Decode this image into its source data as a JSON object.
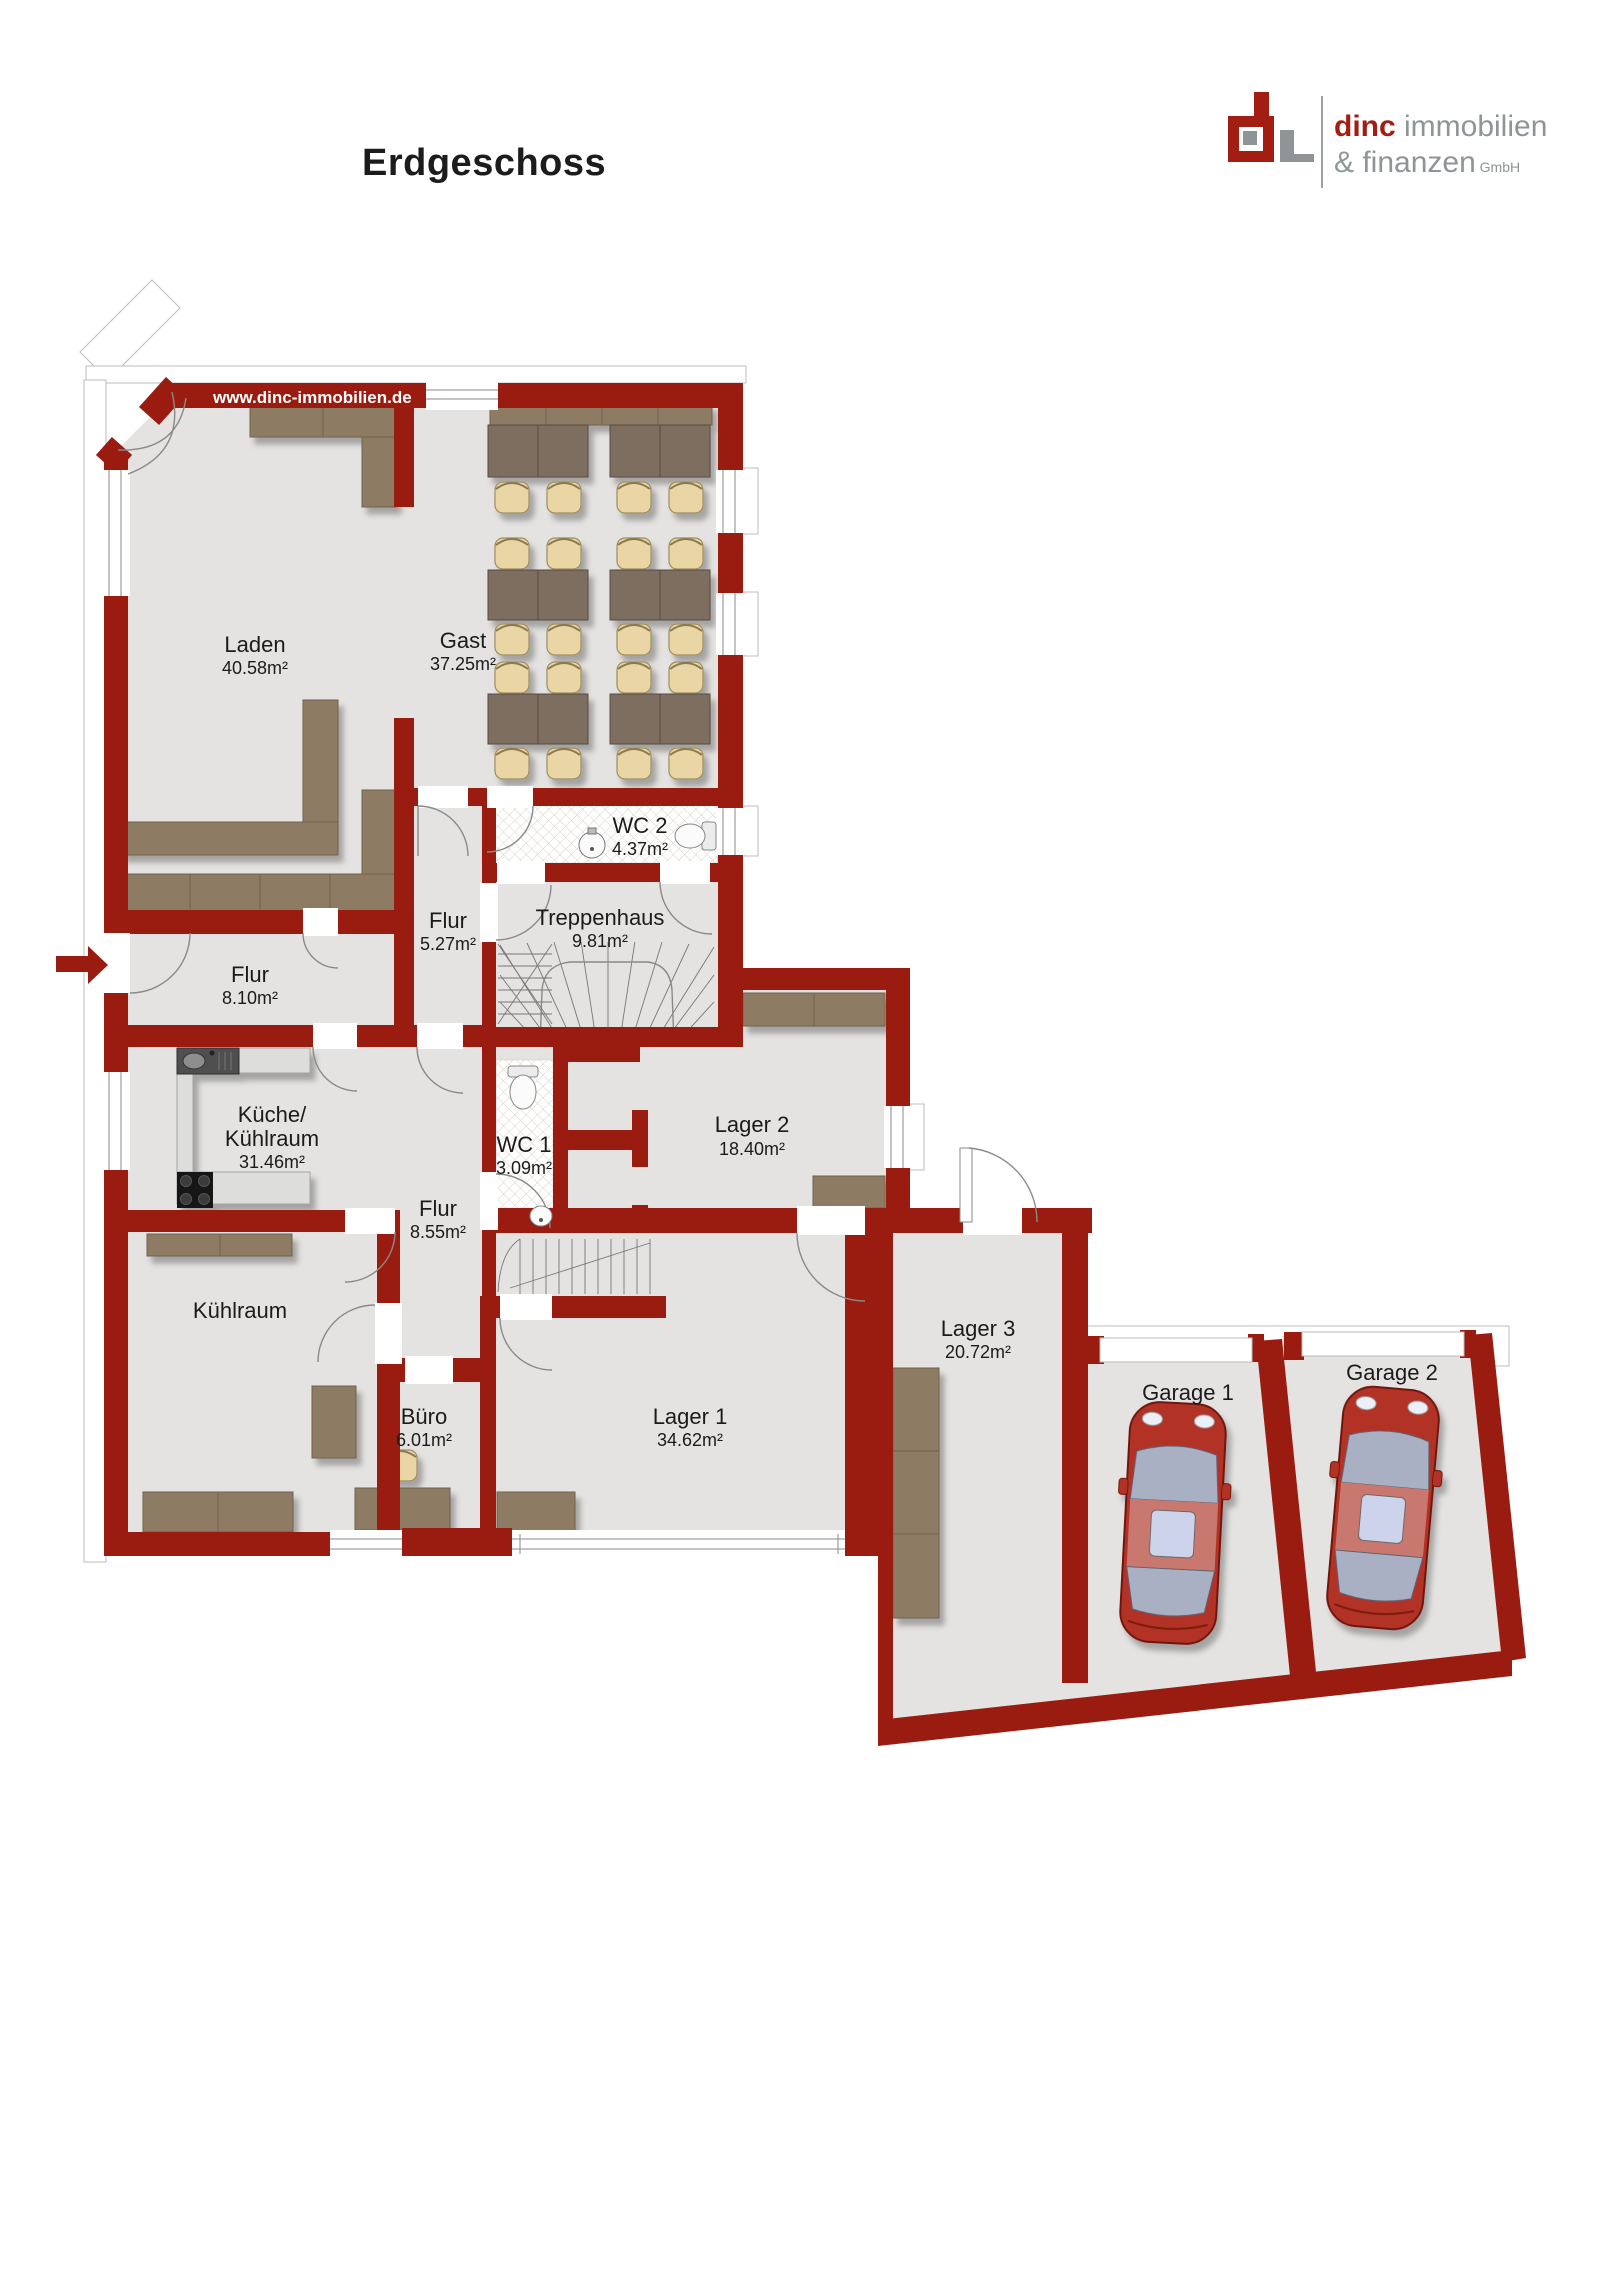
{
  "page": {
    "title": "Erdgeschoss"
  },
  "logo": {
    "name_bold": "dinc",
    "name_rest": " immobilien",
    "line2": "& finanzen",
    "suffix": " GmbH"
  },
  "plan": {
    "watermark": "www.dinc-immobilien.de",
    "rooms": [
      {
        "id": "laden",
        "name": "Laden",
        "area": "40.58m²"
      },
      {
        "id": "gast",
        "name": "Gast",
        "area": "37.25m²"
      },
      {
        "id": "wc2",
        "name": "WC 2",
        "area": "4.37m²"
      },
      {
        "id": "flur-og",
        "name": "Flur",
        "area": "5.27m²"
      },
      {
        "id": "treppenhaus",
        "name": "Treppenhaus",
        "area": "9.81m²"
      },
      {
        "id": "flur-eingang",
        "name": "Flur",
        "area": "8.10m²"
      },
      {
        "id": "kueche",
        "name": "Küche/",
        "name2": "Kühlraum",
        "area": "31.46m²"
      },
      {
        "id": "wc1",
        "name": "WC 1",
        "area": "3.09m²"
      },
      {
        "id": "lager2",
        "name": "Lager 2",
        "area": "18.40m²"
      },
      {
        "id": "flur-mitte",
        "name": "Flur",
        "area": "8.55m²"
      },
      {
        "id": "kuehlraum",
        "name": "Kühlraum",
        "area": ""
      },
      {
        "id": "buero",
        "name": "Büro",
        "area": "6.01m²"
      },
      {
        "id": "lager1",
        "name": "Lager 1",
        "area": "34.62m²"
      },
      {
        "id": "lager3",
        "name": "Lager 3",
        "area": "20.72m²"
      },
      {
        "id": "garage1",
        "name": "Garage 1",
        "area": ""
      },
      {
        "id": "garage2",
        "name": "Garage 2",
        "area": ""
      }
    ],
    "colors": {
      "wall": "#9a1c10",
      "floor": "#e4e3e1",
      "furniture": "#8d7c63",
      "table": "#7d6e5e",
      "chair": "#e9d6a4",
      "car_body": "#b33226",
      "logo_red": "#a21d12",
      "logo_gray": "#8f9496"
    }
  }
}
